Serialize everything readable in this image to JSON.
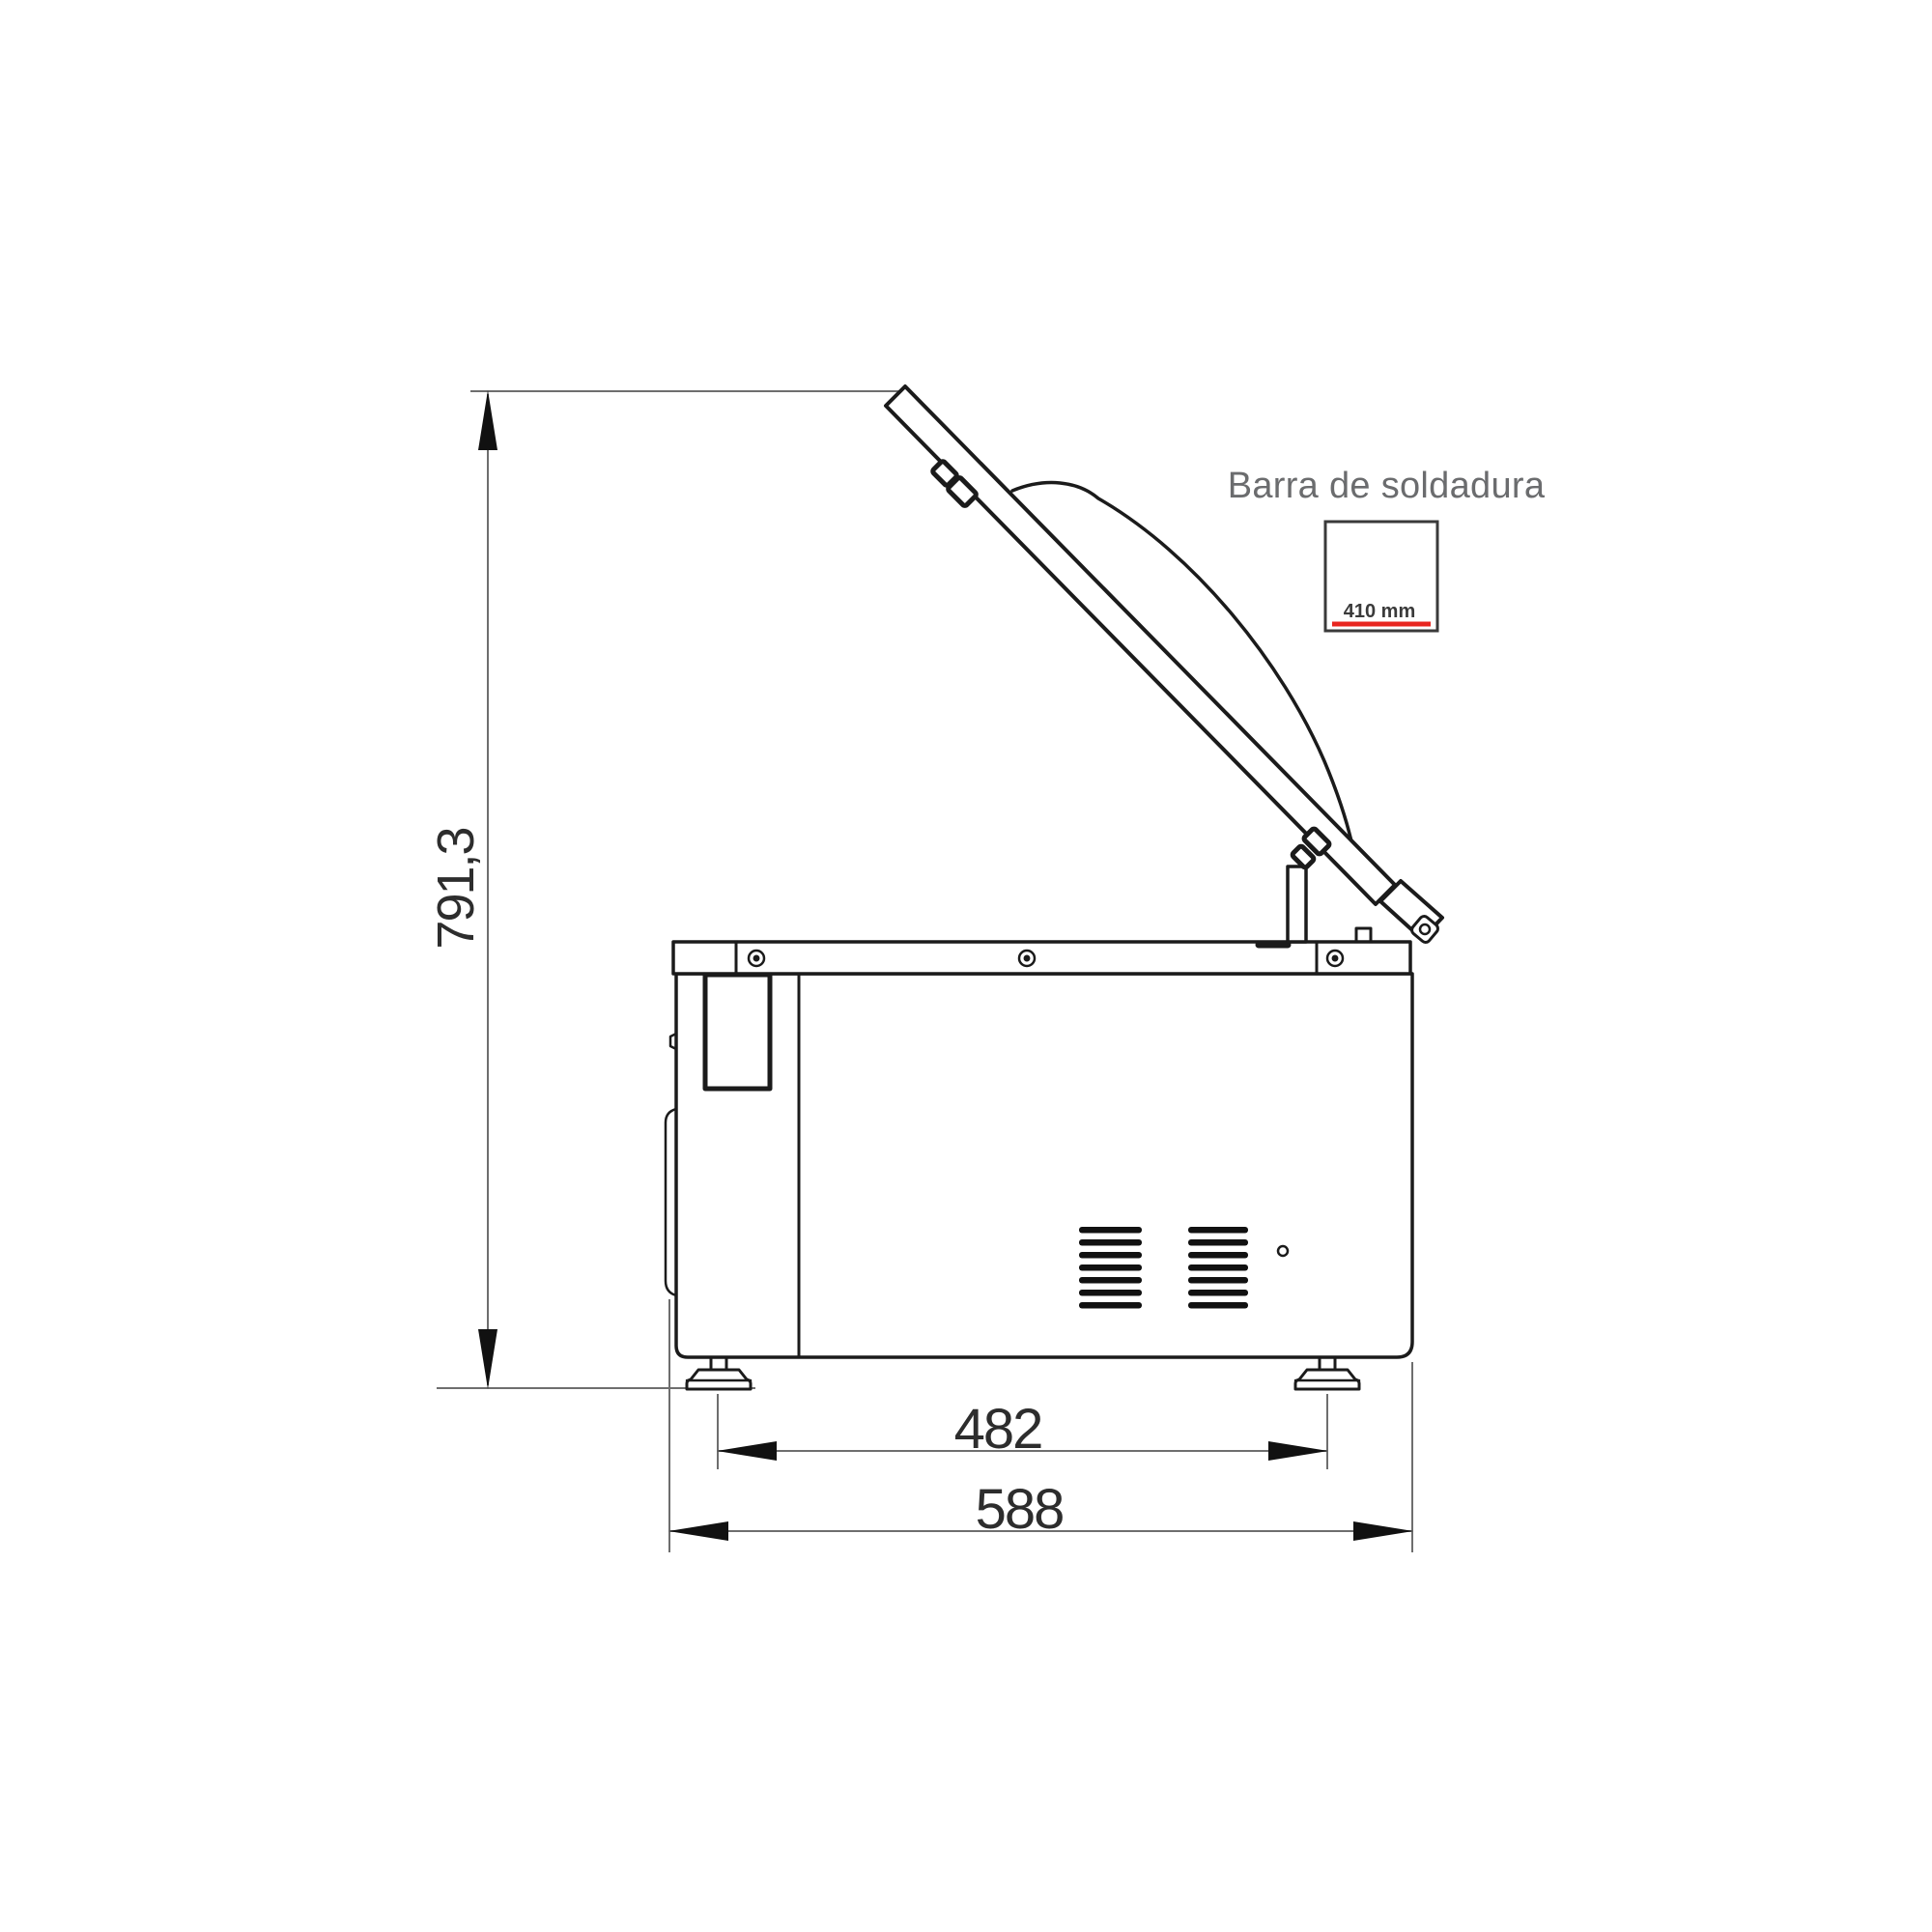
{
  "figure": {
    "welding_bar": {
      "title": "Barra de soldadura",
      "size_label": "410 mm"
    },
    "dimensions": {
      "height": "791,3",
      "foot_span": "482",
      "overall_depth": "588"
    },
    "colors": {
      "outline": "#1b1b1b",
      "dimension_line": "#6e6e6e",
      "arrowhead": "#111111",
      "title_text": "#6b6c6e",
      "dimension_text": "#2d2d2d",
      "welding_bar_underline": "#e8251f",
      "background": "#ffffff"
    }
  }
}
